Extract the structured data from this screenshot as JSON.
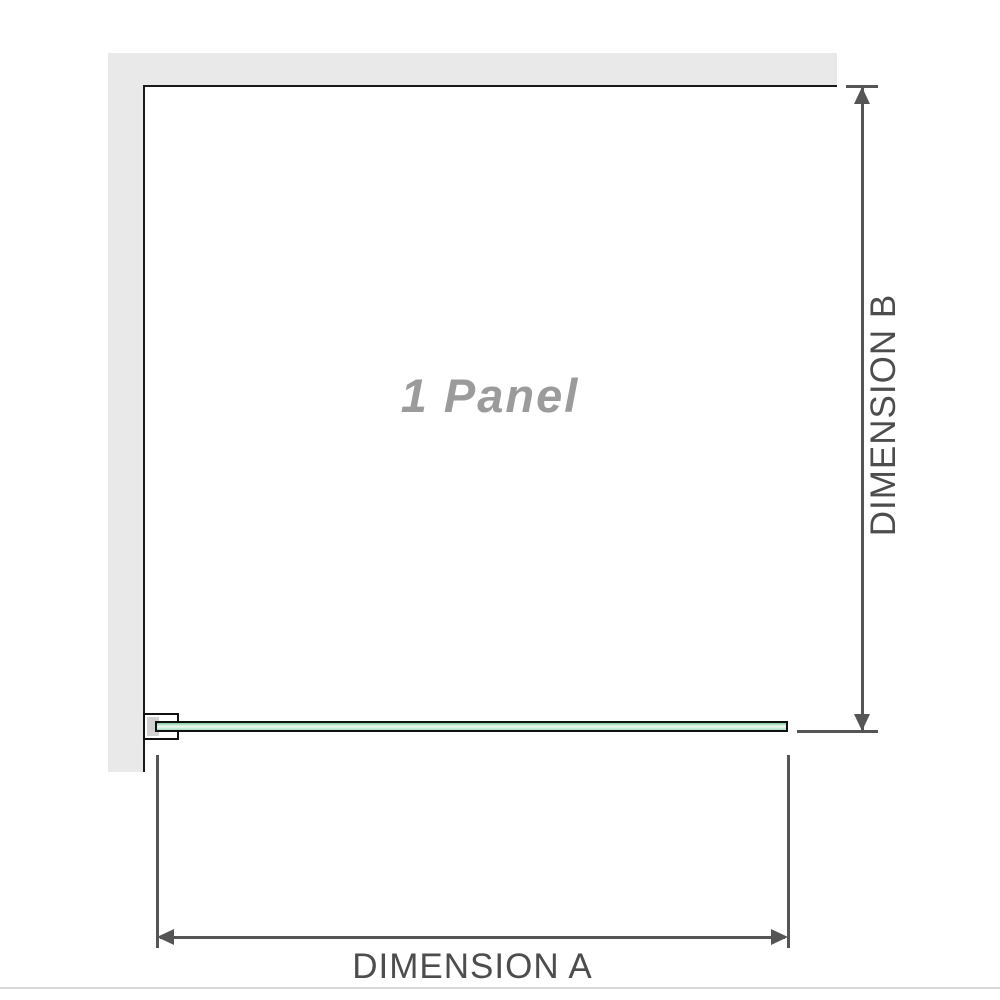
{
  "diagram": {
    "panel_label": "1 Panel",
    "dimension_a_label": "DIMENSION A",
    "dimension_b_label": "DIMENSION B"
  },
  "colors": {
    "wall": "#e9e9e9",
    "panel_border": "#1a1a1a",
    "panel_text": "#9b9b9b",
    "glass_outline": "#111111",
    "bracket_fill": "#ffffff",
    "bracket_insert": "#d2d2d2",
    "dimension": "#555555",
    "dimension_text": "#4d4d4d",
    "divider": "#d9d9d9"
  }
}
